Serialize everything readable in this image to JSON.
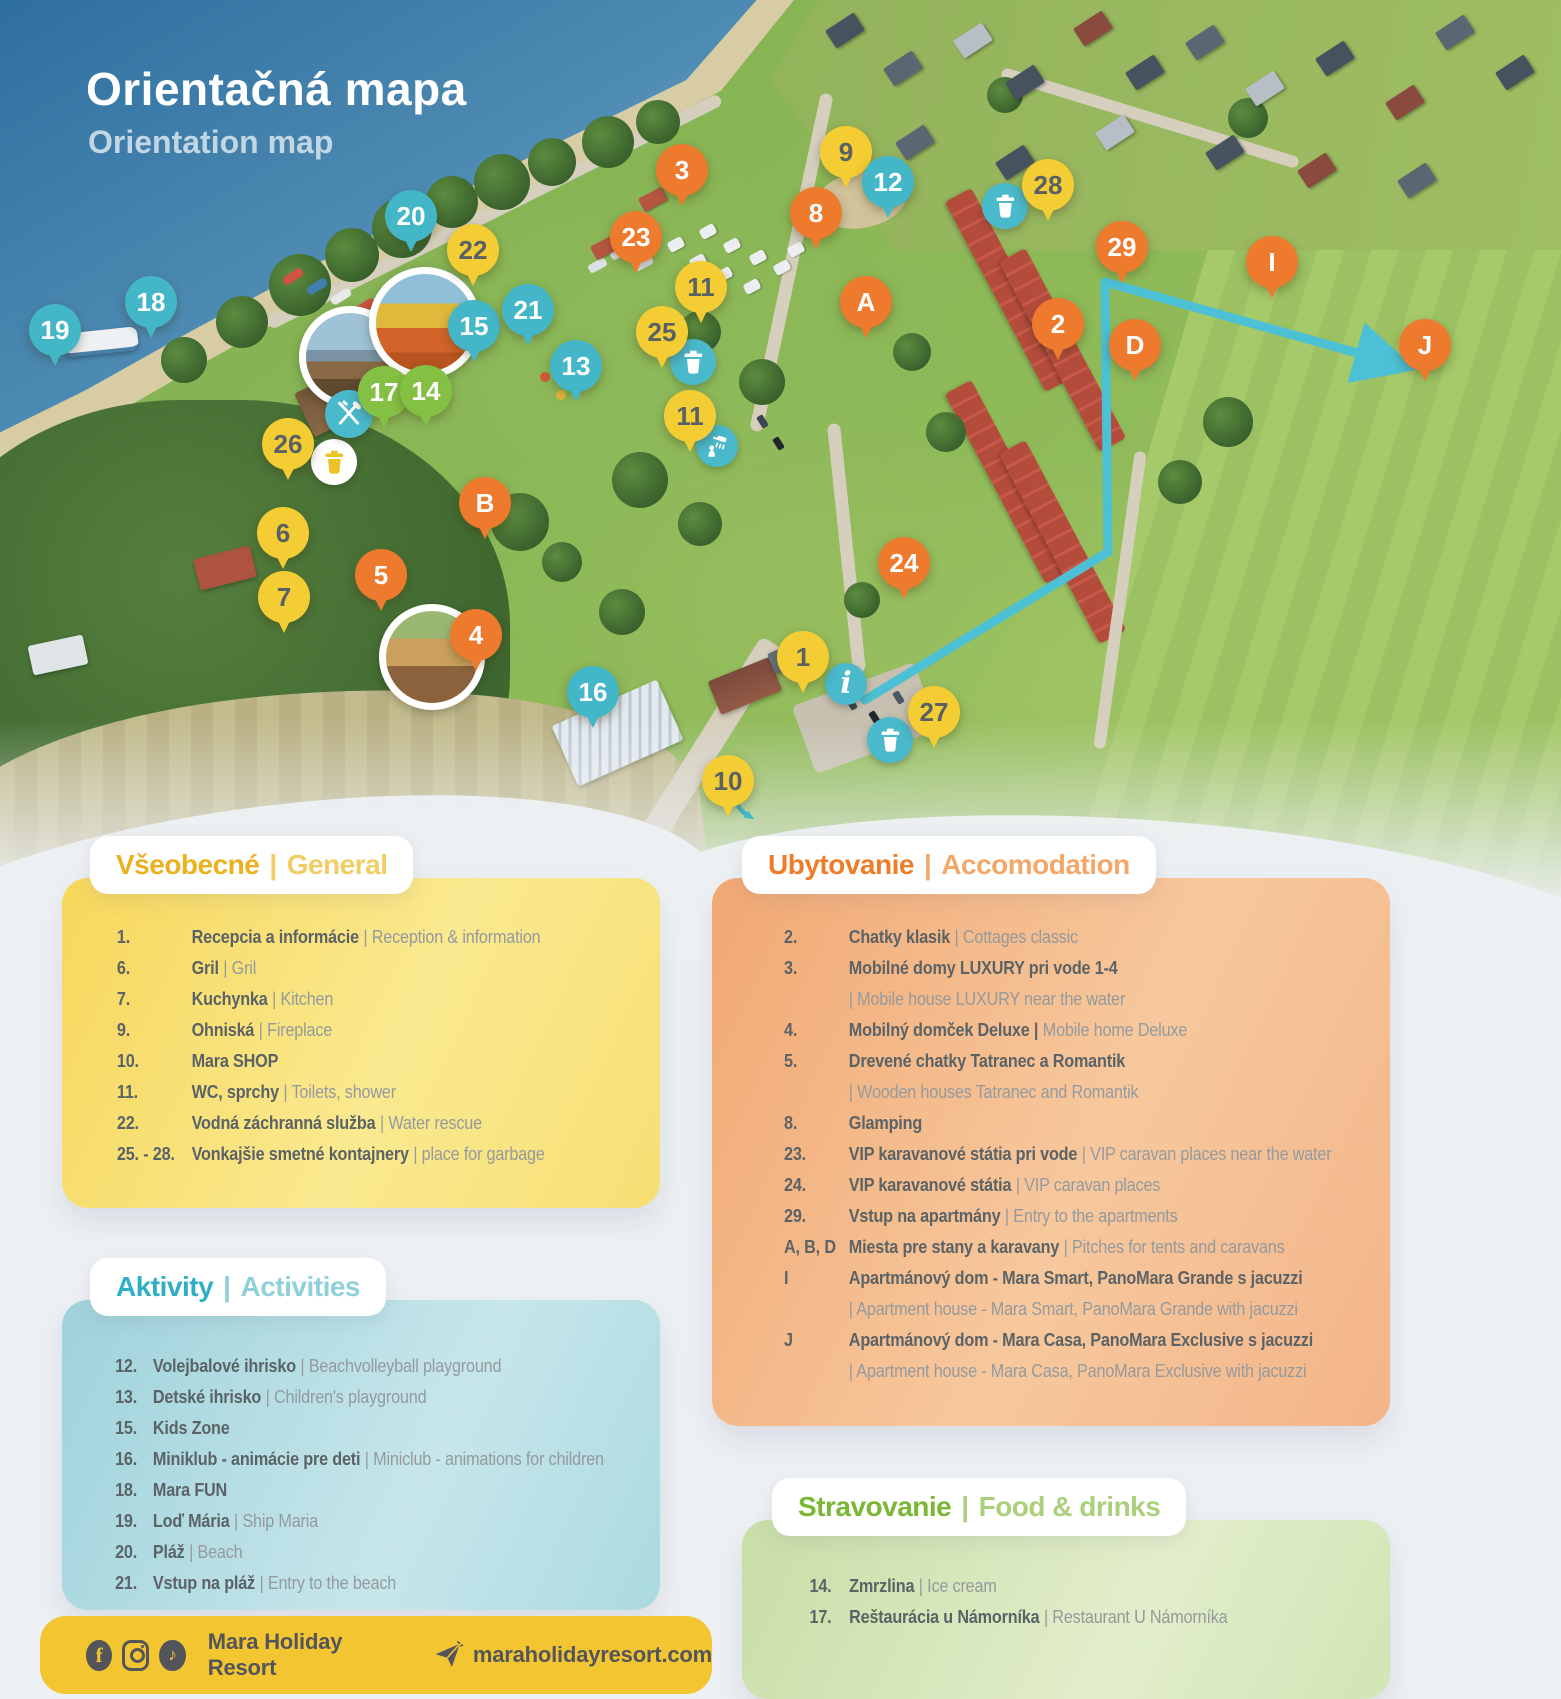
{
  "sep": "|",
  "title": {
    "sk": "Orientačná mapa",
    "en": "Orientation map"
  },
  "panels": {
    "general": {
      "title_sk": "Všeobecné",
      "title_en": "General",
      "items": [
        {
          "num": "1.",
          "sk": "Recepcia a informácie",
          "en": "| Reception & information"
        },
        {
          "num": "6.",
          "sk": "Gril",
          "en": "| Gril"
        },
        {
          "num": "7.",
          "sk": "Kuchynka",
          "en": "| Kitchen"
        },
        {
          "num": "9.",
          "sk": "Ohniská",
          "en": "| Fireplace"
        },
        {
          "num": "10.",
          "sk": "Mara SHOP",
          "en": ""
        },
        {
          "num": "11.",
          "sk": "WC, sprchy",
          "en": "| Toilets, shower"
        },
        {
          "num": "22.",
          "sk": "Vodná záchranná služba",
          "en": "| Water rescue"
        },
        {
          "num": "25. - 28.",
          "sk": "Vonkajšie smetné kontajnery",
          "en": "| place for garbage"
        }
      ]
    },
    "accommodation": {
      "title_sk": "Ubytovanie",
      "title_en": "Accomodation",
      "items": [
        {
          "num": "2.",
          "sk": "Chatky klasik",
          "en": "| Cottages classic"
        },
        {
          "num": "3.",
          "sk": "Mobilné domy LUXURY pri vode 1-4",
          "en": "",
          "en2": "| Mobile house LUXURY near the water"
        },
        {
          "num": "4.",
          "sk": "Mobilný domček Deluxe |",
          "en": "Mobile home Deluxe"
        },
        {
          "num": "5.",
          "sk": "Drevené chatky Tatranec a Romantik",
          "en": "",
          "en2": "| Wooden houses Tatranec and Romantik"
        },
        {
          "num": "8.",
          "sk": "Glamping",
          "en": ""
        },
        {
          "num": "23.",
          "sk": "VIP karavanové státia pri vode",
          "en": "| VIP caravan places near the water"
        },
        {
          "num": "24.",
          "sk": "VIP karavanové státia",
          "en": "| VIP caravan places"
        },
        {
          "num": "29.",
          "sk": "Vstup na apartmány",
          "en": "| Entry to the apartments"
        },
        {
          "num": "A, B, D",
          "sk": "Miesta pre stany a karavany",
          "en": "| Pitches for tents and caravans"
        },
        {
          "num": "I",
          "sk": "Apartmánový dom - Mara Smart, PanoMara Grande s jacuzzi",
          "en": "",
          "en2": "| Apartment house - Mara Smart, PanoMara Grande with jacuzzi"
        },
        {
          "num": "J",
          "sk": "Apartmánový dom - Mara Casa, PanoMara Exclusive s jacuzzi",
          "en": "",
          "en2": "| Apartment house - Mara Casa, PanoMara Exclusive with jacuzzi"
        }
      ]
    },
    "activities": {
      "title_sk": "Aktivity",
      "title_en": "Activities",
      "items": [
        {
          "num": "12.",
          "sk": "Volejbalové ihrisko",
          "en": "| Beachvolleyball playground"
        },
        {
          "num": "13.",
          "sk": "Detské ihrisko",
          "en": "| Children's playground"
        },
        {
          "num": "15.",
          "sk": "Kids Zone",
          "en": ""
        },
        {
          "num": "16.",
          "sk": "Miniklub - animácie pre deti",
          "en": "| Miniclub - animations for children"
        },
        {
          "num": "18.",
          "sk": "Mara FUN",
          "en": ""
        },
        {
          "num": "19.",
          "sk": "Loď Mária",
          "en": "| Ship Maria"
        },
        {
          "num": "20.",
          "sk": "Pláž",
          "en": "| Beach"
        },
        {
          "num": "21.",
          "sk": "Vstup na pláž",
          "en": "| Entry to the beach"
        }
      ]
    },
    "food": {
      "title_sk": "Stravovanie",
      "title_en": "Food & drinks",
      "items": [
        {
          "num": "14.",
          "sk": "Zmrzlina",
          "en": "| Ice cream"
        },
        {
          "num": "17.",
          "sk": "Reštaurácia u Námorníka",
          "en": "| Restaurant U Námorníka"
        }
      ]
    }
  },
  "footer": {
    "brand": "Mara Holiday Resort",
    "website": "maraholidayresort.com",
    "social": [
      "facebook-icon",
      "instagram-icon",
      "tiktok-icon",
      "send-icon"
    ]
  },
  "map": {
    "colors": {
      "teal": "#43b7c7",
      "yellow": "#f3cd33",
      "orange": "#ee7a2d",
      "green": "#84c043",
      "route": "#4cc0d4"
    },
    "pins": [
      {
        "label": "19",
        "kind": "teal",
        "x": 55,
        "y": 330
      },
      {
        "label": "18",
        "kind": "teal",
        "x": 151,
        "y": 302
      },
      {
        "label": "20",
        "kind": "teal",
        "x": 411,
        "y": 216
      },
      {
        "label": "22",
        "kind": "yellow",
        "x": 473,
        "y": 250
      },
      {
        "label": "15",
        "kind": "teal",
        "x": 474,
        "y": 326
      },
      {
        "label": "21",
        "kind": "teal",
        "x": 528,
        "y": 310
      },
      {
        "label": "13",
        "kind": "teal",
        "x": 576,
        "y": 366
      },
      {
        "label": "17",
        "kind": "green",
        "x": 384,
        "y": 392
      },
      {
        "label": "14",
        "kind": "green",
        "x": 426,
        "y": 391
      },
      {
        "label": "26",
        "kind": "yellow",
        "x": 288,
        "y": 444
      },
      {
        "label": "3",
        "kind": "orange",
        "x": 682,
        "y": 170
      },
      {
        "label": "23",
        "kind": "orange",
        "x": 636,
        "y": 237
      },
      {
        "label": "9",
        "kind": "yellow",
        "x": 846,
        "y": 152
      },
      {
        "label": "8",
        "kind": "orange",
        "x": 816,
        "y": 213
      },
      {
        "label": "12",
        "kind": "teal",
        "x": 888,
        "y": 182
      },
      {
        "label": "28",
        "kind": "yellow",
        "x": 1048,
        "y": 185
      },
      {
        "label": "11",
        "kind": "yellow",
        "x": 701,
        "y": 287
      },
      {
        "label": "25",
        "kind": "yellow",
        "x": 662,
        "y": 332
      },
      {
        "label": "A",
        "kind": "orange",
        "x": 866,
        "y": 302
      },
      {
        "label": "2",
        "kind": "orange",
        "x": 1058,
        "y": 324
      },
      {
        "label": "29",
        "kind": "orange",
        "x": 1122,
        "y": 247
      },
      {
        "label": "D",
        "kind": "orange",
        "x": 1135,
        "y": 345
      },
      {
        "label": "I",
        "kind": "orange",
        "x": 1272,
        "y": 262
      },
      {
        "label": "J",
        "kind": "orange",
        "x": 1425,
        "y": 345
      },
      {
        "label": "11",
        "kind": "yellow",
        "x": 690,
        "y": 416
      },
      {
        "label": "B",
        "kind": "orange",
        "x": 485,
        "y": 503
      },
      {
        "label": "6",
        "kind": "yellow",
        "x": 283,
        "y": 533
      },
      {
        "label": "5",
        "kind": "orange",
        "x": 381,
        "y": 575
      },
      {
        "label": "7",
        "kind": "yellow",
        "x": 284,
        "y": 597
      },
      {
        "label": "4",
        "kind": "orange",
        "x": 476,
        "y": 635
      },
      {
        "label": "24",
        "kind": "orange",
        "x": 904,
        "y": 563
      },
      {
        "label": "16",
        "kind": "teal",
        "x": 593,
        "y": 692
      },
      {
        "label": "1",
        "kind": "yellow",
        "x": 803,
        "y": 657
      },
      {
        "label": "27",
        "kind": "yellow",
        "x": 934,
        "y": 712
      },
      {
        "label": "10",
        "kind": "yellow",
        "x": 728,
        "y": 781
      }
    ],
    "badges": [
      {
        "icon": "trash",
        "style": "white",
        "x": 334,
        "y": 462,
        "size": 46
      },
      {
        "icon": "trash",
        "style": "teal",
        "x": 1005,
        "y": 206,
        "size": 46
      },
      {
        "icon": "trash",
        "style": "teal",
        "x": 693,
        "y": 362,
        "size": 46
      },
      {
        "icon": "trash",
        "style": "teal",
        "x": 890,
        "y": 740,
        "size": 46
      },
      {
        "icon": "restaurant",
        "style": "teal",
        "x": 349,
        "y": 414,
        "size": 48
      },
      {
        "icon": "shower",
        "style": "teal",
        "x": 717,
        "y": 446,
        "size": 42
      },
      {
        "icon": "info",
        "style": "teal",
        "x": 846,
        "y": 684,
        "size": 42
      },
      {
        "icon": "arrow",
        "style": "plain",
        "x": 745,
        "y": 812,
        "size": 40
      }
    ]
  }
}
